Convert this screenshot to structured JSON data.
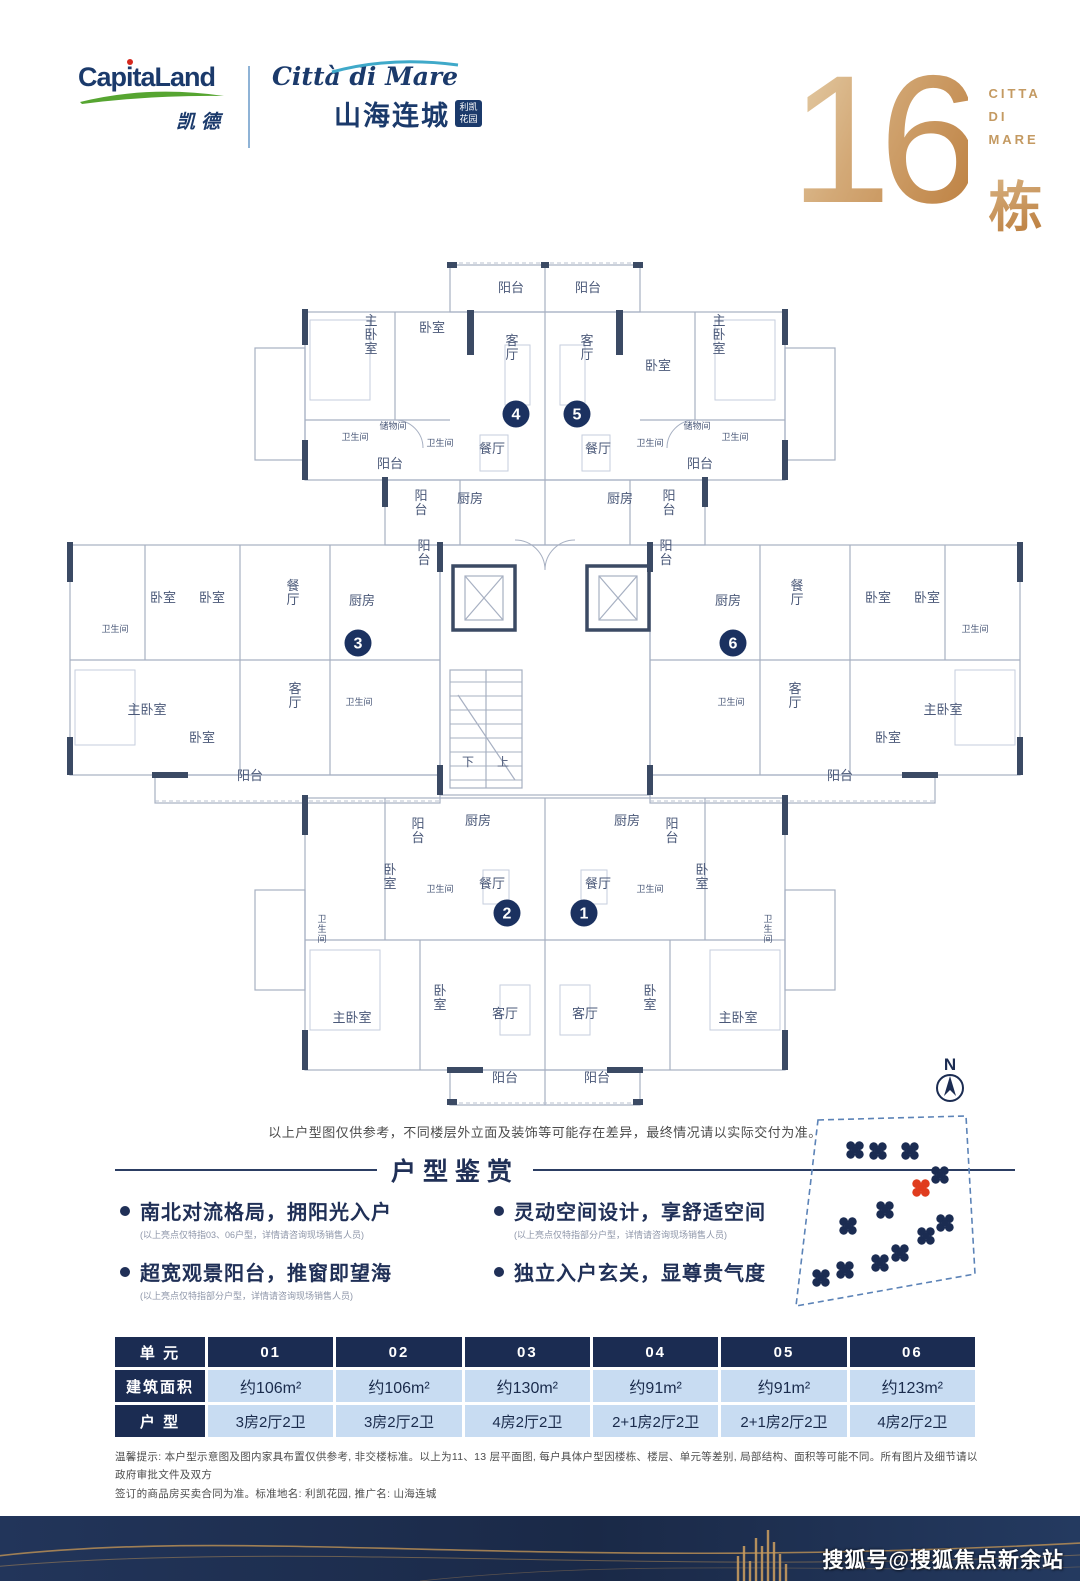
{
  "header": {
    "capitaland": {
      "name": "CapitaLand",
      "cn": "凯德"
    },
    "citta": {
      "script": "Città di Mare",
      "cn": "山海连城",
      "badge1": "利凯",
      "badge2": "花园"
    },
    "building_no": "16",
    "citta_lines": [
      "CITTA",
      "DI",
      "MARE"
    ],
    "dong": "栋"
  },
  "plan": {
    "disclaimer": "以上户型图仅供参考，不同楼层外立面及装饰等可能存在差异，最终情况请以实际交付为准。",
    "stair_down": "下",
    "stair_up": "上",
    "units": [
      {
        "n": "4",
        "x": 461,
        "y": 164
      },
      {
        "n": "5",
        "x": 522,
        "y": 164
      },
      {
        "n": "3",
        "x": 303,
        "y": 393
      },
      {
        "n": "6",
        "x": 678,
        "y": 393
      },
      {
        "n": "2",
        "x": 452,
        "y": 663
      },
      {
        "n": "1",
        "x": 529,
        "y": 663
      }
    ],
    "labels": [
      {
        "t": "阳台",
        "x": 456,
        "y": 42
      },
      {
        "t": "阳台",
        "x": 533,
        "y": 42
      },
      {
        "t": "客厅",
        "x": 457,
        "y": 95,
        "v": 1
      },
      {
        "t": "客厅",
        "x": 532,
        "y": 95,
        "v": 1
      },
      {
        "t": "主卧室",
        "x": 316,
        "y": 75,
        "v": 1
      },
      {
        "t": "卧室",
        "x": 377,
        "y": 82
      },
      {
        "t": "卧室",
        "x": 603,
        "y": 120
      },
      {
        "t": "主卧室",
        "x": 664,
        "y": 75,
        "v": 1
      },
      {
        "t": "卫生间",
        "x": 300,
        "y": 190,
        "s": 9
      },
      {
        "t": "储物间",
        "x": 338,
        "y": 179,
        "s": 9
      },
      {
        "t": "卫生间",
        "x": 385,
        "y": 196,
        "s": 9
      },
      {
        "t": "餐厅",
        "x": 437,
        "y": 203
      },
      {
        "t": "餐厅",
        "x": 543,
        "y": 203
      },
      {
        "t": "卫生间",
        "x": 595,
        "y": 196,
        "s": 9
      },
      {
        "t": "储物间",
        "x": 642,
        "y": 179,
        "s": 9
      },
      {
        "t": "卫生间",
        "x": 680,
        "y": 190,
        "s": 9
      },
      {
        "t": "阳台",
        "x": 335,
        "y": 218
      },
      {
        "t": "阳台",
        "x": 645,
        "y": 218
      },
      {
        "t": "阳台",
        "x": 366,
        "y": 250,
        "v": 1
      },
      {
        "t": "厨房",
        "x": 415,
        "y": 253
      },
      {
        "t": "厨房",
        "x": 565,
        "y": 253
      },
      {
        "t": "阳台",
        "x": 614,
        "y": 250,
        "v": 1
      },
      {
        "t": "阳台",
        "x": 369,
        "y": 300,
        "v": 1
      },
      {
        "t": "阳台",
        "x": 611,
        "y": 300,
        "v": 1
      },
      {
        "t": "卧室",
        "x": 108,
        "y": 352
      },
      {
        "t": "卧室",
        "x": 157,
        "y": 352
      },
      {
        "t": "餐厅",
        "x": 238,
        "y": 340,
        "v": 1
      },
      {
        "t": "厨房",
        "x": 307,
        "y": 355
      },
      {
        "t": "卫生间",
        "x": 60,
        "y": 382,
        "s": 9
      },
      {
        "t": "主卧室",
        "x": 92,
        "y": 464
      },
      {
        "t": "卧室",
        "x": 147,
        "y": 492
      },
      {
        "t": "客厅",
        "x": 240,
        "y": 443,
        "v": 1
      },
      {
        "t": "卫生间",
        "x": 304,
        "y": 455,
        "s": 9
      },
      {
        "t": "阳台",
        "x": 195,
        "y": 530
      },
      {
        "t": "厨房",
        "x": 673,
        "y": 355
      },
      {
        "t": "餐厅",
        "x": 742,
        "y": 340,
        "v": 1
      },
      {
        "t": "卧室",
        "x": 823,
        "y": 352
      },
      {
        "t": "卧室",
        "x": 872,
        "y": 352
      },
      {
        "t": "卫生间",
        "x": 920,
        "y": 382,
        "s": 9
      },
      {
        "t": "客厅",
        "x": 740,
        "y": 443,
        "v": 1
      },
      {
        "t": "卫生间",
        "x": 676,
        "y": 455,
        "s": 9
      },
      {
        "t": "卧室",
        "x": 833,
        "y": 492
      },
      {
        "t": "主卧室",
        "x": 888,
        "y": 464
      },
      {
        "t": "阳台",
        "x": 785,
        "y": 530
      },
      {
        "t": "阳台",
        "x": 363,
        "y": 578,
        "v": 1
      },
      {
        "t": "厨房",
        "x": 423,
        "y": 575
      },
      {
        "t": "厨房",
        "x": 572,
        "y": 575
      },
      {
        "t": "阳台",
        "x": 617,
        "y": 578,
        "v": 1
      },
      {
        "t": "卧室",
        "x": 335,
        "y": 624,
        "v": 1
      },
      {
        "t": "卫生间",
        "x": 385,
        "y": 642,
        "s": 9
      },
      {
        "t": "餐厅",
        "x": 437,
        "y": 638
      },
      {
        "t": "餐厅",
        "x": 543,
        "y": 638
      },
      {
        "t": "卫生间",
        "x": 595,
        "y": 642,
        "s": 9
      },
      {
        "t": "卧室",
        "x": 647,
        "y": 624,
        "v": 1
      },
      {
        "t": "卫生间",
        "x": 267,
        "y": 672,
        "v": 1,
        "s": 9
      },
      {
        "t": "卫生间",
        "x": 713,
        "y": 672,
        "v": 1,
        "s": 9
      },
      {
        "t": "主卧室",
        "x": 297,
        "y": 772
      },
      {
        "t": "卧室",
        "x": 385,
        "y": 745,
        "v": 1
      },
      {
        "t": "客厅",
        "x": 450,
        "y": 768
      },
      {
        "t": "客厅",
        "x": 530,
        "y": 768
      },
      {
        "t": "卧室",
        "x": 595,
        "y": 745,
        "v": 1
      },
      {
        "t": "主卧室",
        "x": 683,
        "y": 772
      },
      {
        "t": "阳台",
        "x": 450,
        "y": 832
      },
      {
        "t": "阳台",
        "x": 542,
        "y": 832
      }
    ]
  },
  "highlights": {
    "title": "户型鉴赏",
    "items": [
      {
        "title": "南北对流格局，拥阳光入户",
        "note": "(以上亮点仅特指03、06户型，详情请咨询现场销售人员)"
      },
      {
        "title": "超宽观景阳台，推窗即望海",
        "note": "(以上亮点仅特指部分户型，详情请咨询现场销售人员)"
      },
      {
        "title": "灵动空间设计，享舒适空间",
        "note": "(以上亮点仅特指部分户型，详情请咨询现场销售人员)"
      },
      {
        "title": "独立入户玄关，显尊贵气度",
        "note": ""
      }
    ]
  },
  "sitemap": {
    "compass": "N",
    "boundary": "40,82 188,78 197,236 18,268",
    "buildings": [
      {
        "x": 77,
        "y": 112
      },
      {
        "x": 100,
        "y": 113
      },
      {
        "x": 132,
        "y": 113
      },
      {
        "x": 162,
        "y": 137
      },
      {
        "x": 143,
        "y": 150,
        "red": true
      },
      {
        "x": 107,
        "y": 172
      },
      {
        "x": 70,
        "y": 188
      },
      {
        "x": 167,
        "y": 185
      },
      {
        "x": 148,
        "y": 198
      },
      {
        "x": 122,
        "y": 215
      },
      {
        "x": 102,
        "y": 225
      },
      {
        "x": 67,
        "y": 232
      },
      {
        "x": 43,
        "y": 240
      }
    ]
  },
  "table": {
    "col1_header": "单 元",
    "units": [
      "01",
      "02",
      "03",
      "04",
      "05",
      "06"
    ],
    "rows": [
      {
        "label": "建筑面积",
        "cls": "area",
        "values": [
          "约106m²",
          "约106m²",
          "约130m²",
          "约91m²",
          "约91m²",
          "约123m²"
        ]
      },
      {
        "label": "户 型",
        "cls": "type",
        "values": [
          "3房2厅2卫",
          "3房2厅2卫",
          "4房2厅2卫",
          "2+1房2厅2卫",
          "2+1房2厅2卫",
          "4房2厅2卫"
        ]
      }
    ]
  },
  "footnote": {
    "line1": "温馨提示: 本户型示意图及图内家具布置仅供参考, 非交楼标准。以上为11、13 层平面图, 每户具体户型因楼栋、楼层、单元等差别, 局部结构、面积等可能不同。所有图片及细节请以政府审批文件及双方",
    "line2": "签订的商品房买卖合同为准。标准地名: 利凯花园, 推广名: 山海连城"
  },
  "footer": {
    "watermark": "搜狐号@搜狐焦点新余站"
  },
  "colors": {
    "navy": "#1b2c52",
    "gold": "#c49a62",
    "cell_blue": "#c8dcf2",
    "plan_line": "#a7b0c2",
    "plan_wall": "#3b4a64",
    "plan_text": "#4a5878",
    "red_building": "#e03c1e"
  }
}
